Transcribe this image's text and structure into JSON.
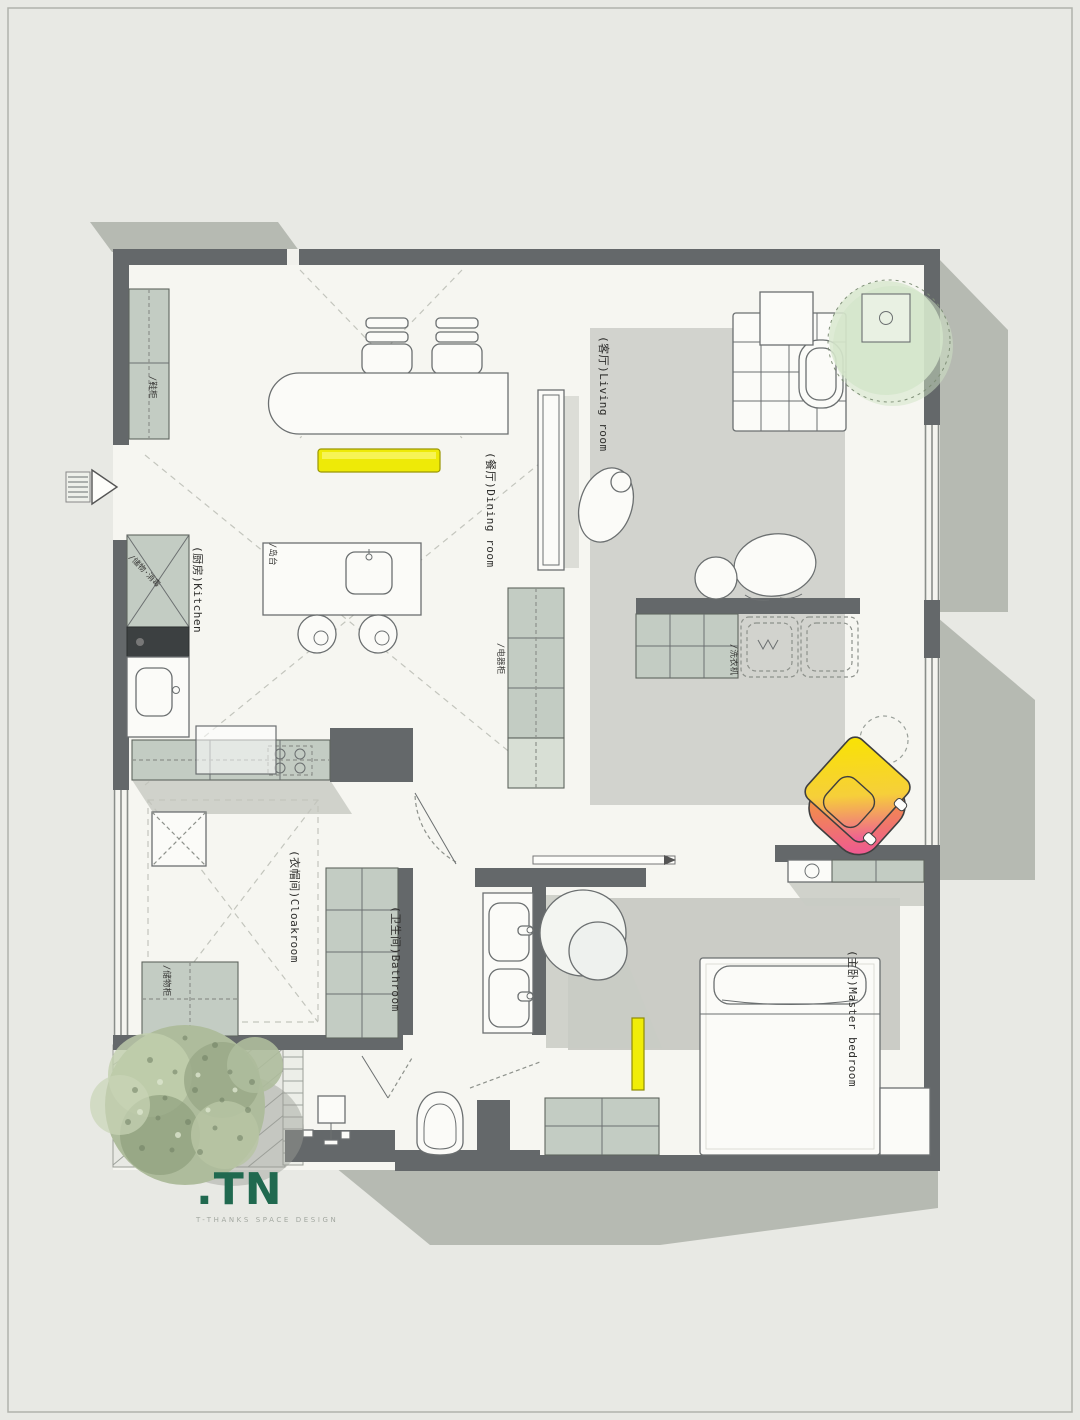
{
  "document": {
    "type": "residential floor plan rendering"
  },
  "rooms": [
    {
      "id": "living-room",
      "label": "(客厅)Living room"
    },
    {
      "id": "dining-room",
      "label": "(餐厅)Dining room"
    },
    {
      "id": "kitchen",
      "label": "(厨房)Kitchen"
    },
    {
      "id": "cloakroom",
      "label": "(衣帽间)Cloakroom"
    },
    {
      "id": "bathroom",
      "label": "(卫生间)Bathroom"
    },
    {
      "id": "master-bedroom",
      "label": "(主卧)Master bedroom"
    }
  ],
  "annotations": [
    {
      "id": "shoe-cabinet",
      "label": "/鞋柜"
    },
    {
      "id": "island-counter",
      "label": "/岛台"
    },
    {
      "id": "storage-sterilize",
      "label": "/储物·消毒"
    },
    {
      "id": "appliance-cabinet",
      "label": "/电器柜"
    },
    {
      "id": "washing-machine",
      "label": "/洗衣机"
    },
    {
      "id": "storage-cabinet",
      "label": "/储物柜"
    }
  ],
  "logo": {
    "mark": ".TN",
    "tagline": "T-THANKS SPACE DESIGN"
  },
  "colors": {
    "background": "#e8e9e4",
    "floor": "#f6f6f1",
    "wall": "#64686a",
    "cabinet_green": "#c3ccc3",
    "rug_gray": "#d2d3ce",
    "accent_yellow": "#eeea07",
    "chair_gradient_from": "#f9e400",
    "chair_gradient_to": "#ee4fa0",
    "plant_green": "#d4e6cb",
    "logo_green": "#20694f"
  }
}
